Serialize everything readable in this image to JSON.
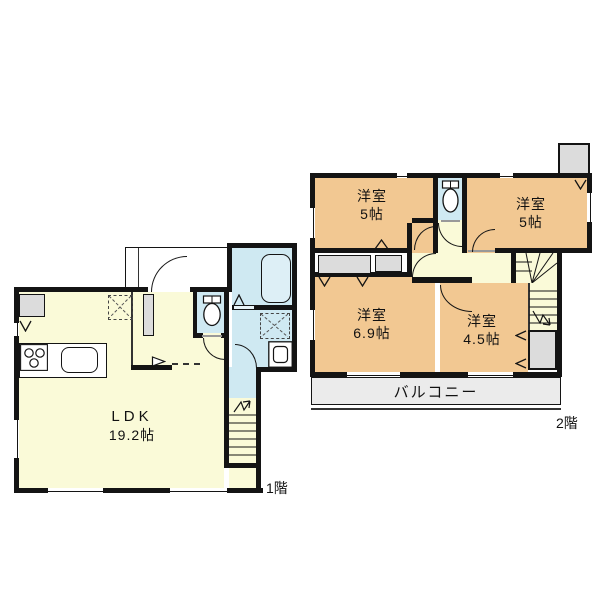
{
  "title": "2-story house floor plan",
  "floor1": {
    "tag": "1階",
    "ldk": {
      "name": "LDK",
      "area": "19.2帖"
    }
  },
  "floor2": {
    "tag": "2階",
    "room_top_left": {
      "name": "洋室",
      "area": "5帖"
    },
    "room_top_right": {
      "name": "洋室",
      "area": "5帖"
    },
    "room_bottom_left": {
      "name": "洋室",
      "area": "6.9帖"
    },
    "room_bottom_right": {
      "name": "洋室",
      "area": "4.5帖"
    },
    "balcony_label": "バルコニー"
  },
  "icons": {
    "toilet": "toilet-icon",
    "bathtub": "bathtub-icon",
    "stove": "stove-icon",
    "sink": "sink-icon",
    "washer_space": "washer-space-dashed-box",
    "vanity": "vanity-icon",
    "stairs_up_arrow": "stairs-direction-arrow"
  },
  "colors": {
    "wall": "#141414",
    "room": "#f2c892",
    "living": "#fafad8",
    "wet": "#cfe9f2",
    "fixture_gray": "#dcdcdc",
    "balcony": "#ebebeb"
  }
}
